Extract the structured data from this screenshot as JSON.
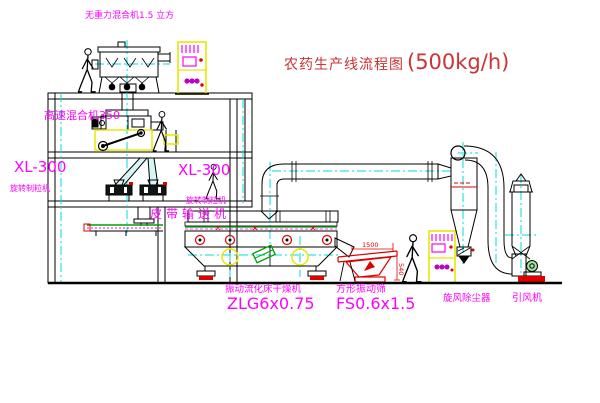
{
  "title": {
    "cn": "农药生产线流程图",
    "rate": "(500kg/h)"
  },
  "labels": {
    "gravity_mixer": "无重力混合机1.5 立方",
    "high_speed_mixer": "高速混合机350",
    "granulator_left_model": "XL-300",
    "granulator_left_name": "旋转制粒机",
    "granulator_right_model": "XL-300",
    "granulator_right_name": "旋转制粒机",
    "belt_conveyor": "皮带输送机",
    "dryer_name": "振动流化床干燥机",
    "dryer_model": "ZLG6x0.75",
    "screen_name": "方形振动筛",
    "screen_model": "FS0.6x1.5",
    "cyclone": "旋风除尘器",
    "fan": "引风机"
  },
  "dimensions": {
    "screen_length": "1500",
    "screen_height": "540"
  },
  "colors": {
    "label_magenta": "#ff00ff",
    "title_red": "#cc3333",
    "centerline_cyan": "#00dcdc",
    "cabinet_yellow": "#e8e800",
    "accent_red": "#e00000",
    "machine_green": "#00a000",
    "line_black": "#000000"
  }
}
